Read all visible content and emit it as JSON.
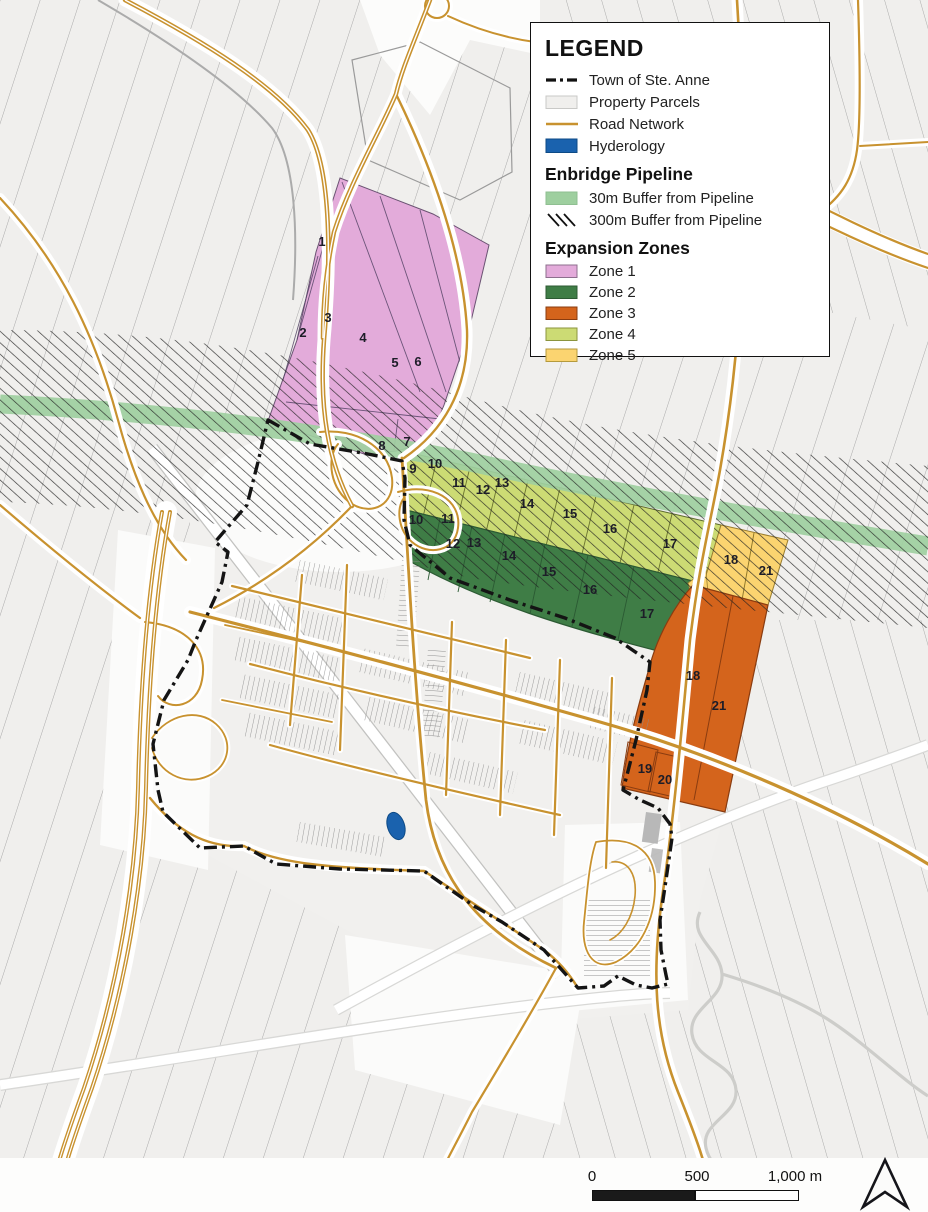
{
  "legend": {
    "title": "LEGEND",
    "items": [
      {
        "label": "Town of Ste. Anne"
      },
      {
        "label": "Property Parcels"
      },
      {
        "label": "Road Network"
      },
      {
        "label": "Hyderology"
      }
    ],
    "pipeline": {
      "title": "Enbridge Pipeline",
      "items": [
        {
          "label": "30m Buffer from Pipeline"
        },
        {
          "label": "300m Buffer from Pipeline"
        }
      ]
    },
    "zones": {
      "title": "Expansion Zones",
      "items": [
        {
          "label": "Zone 1"
        },
        {
          "label": "Zone 2"
        },
        {
          "label": "Zone 3"
        },
        {
          "label": "Zone 4"
        },
        {
          "label": "Zone 5"
        }
      ]
    }
  },
  "colors": {
    "zone1": "#e3abda",
    "zone2": "#3f7d46",
    "zone3": "#d4641c",
    "zone4": "#ccdb74",
    "zone5": "#fbd470",
    "buffer30": "#9ecf9f",
    "road": "#c8922f",
    "hydrology": "#1a62ae",
    "boundary": "#141414"
  },
  "scalebar": {
    "tick0": "0",
    "tick500": "500",
    "tick1000": "1,000 m"
  },
  "parcels": {
    "zone1": [
      "1",
      "2",
      "3",
      "4",
      "5",
      "6",
      "7",
      "8"
    ],
    "zone4": [
      "9",
      "10",
      "11",
      "12",
      "13",
      "14",
      "15",
      "16",
      "17"
    ],
    "zone2": [
      "10",
      "11",
      "12",
      "13",
      "14",
      "15",
      "16",
      "17"
    ],
    "zone5": [
      "18",
      "21"
    ],
    "zone3": [
      "18",
      "21",
      "19",
      "20"
    ]
  }
}
